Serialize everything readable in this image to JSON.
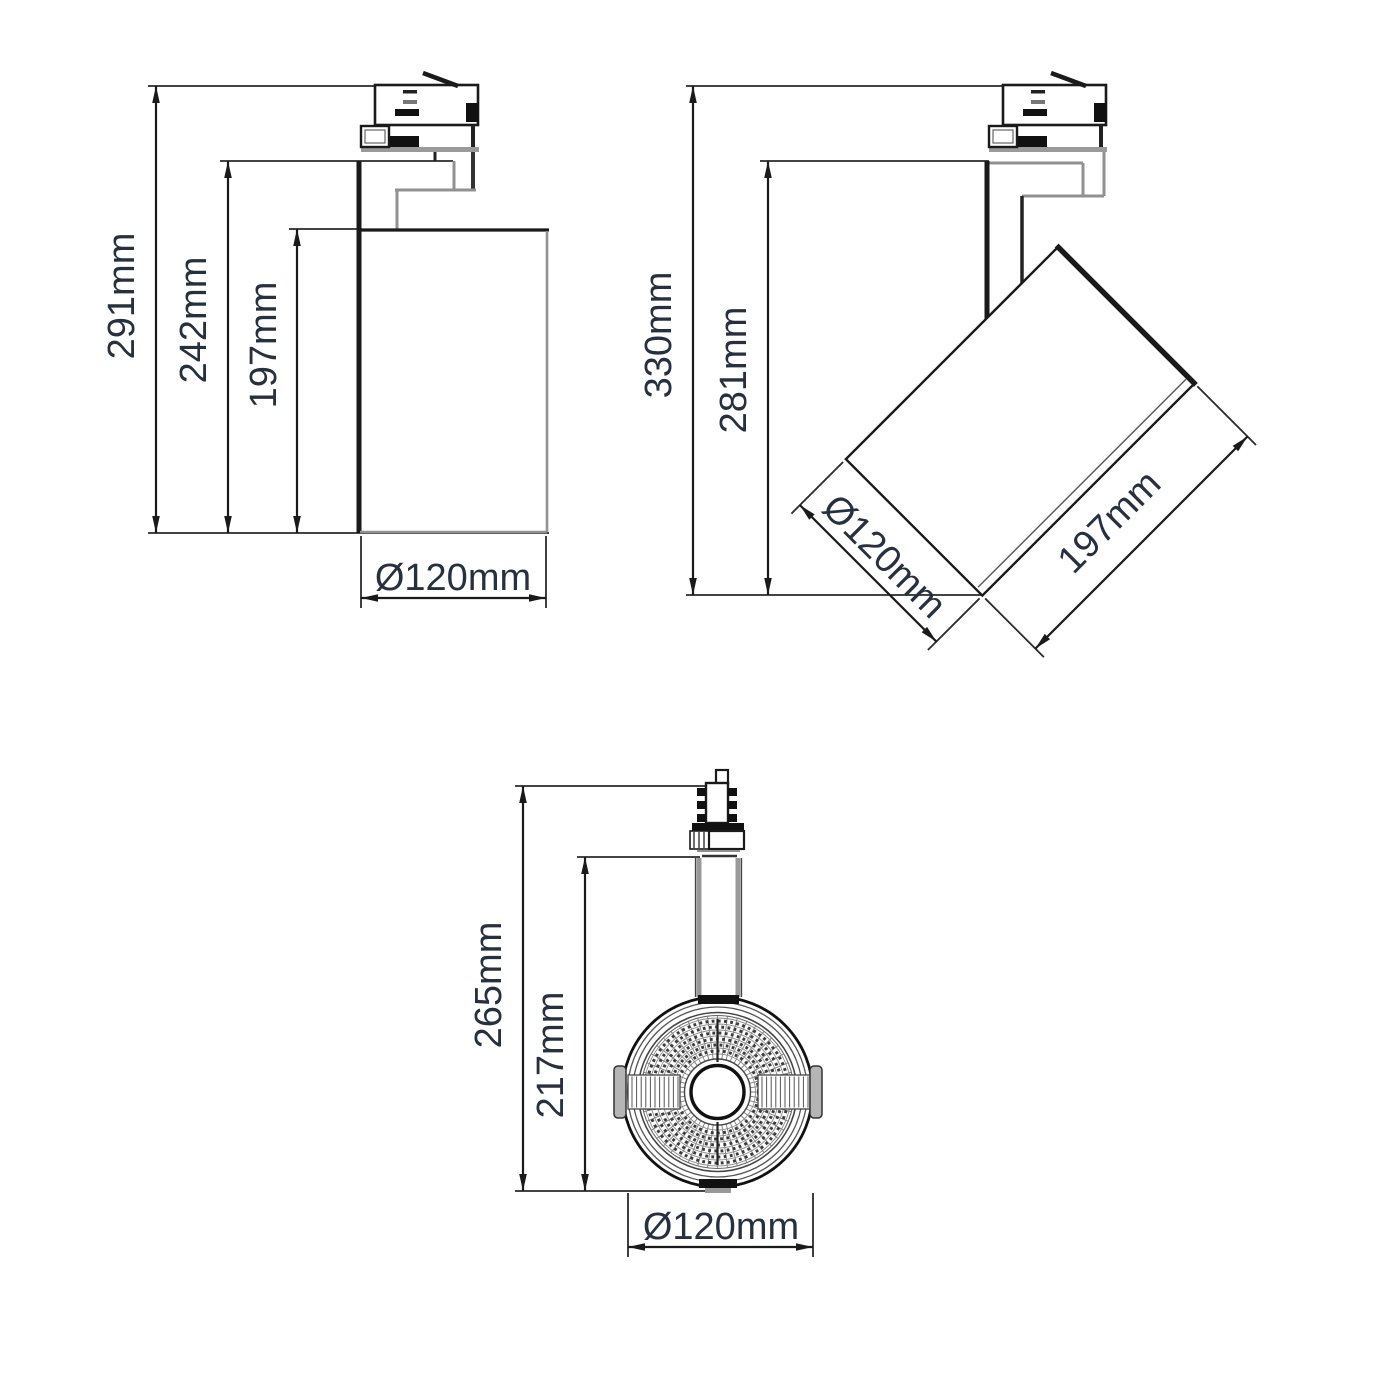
{
  "drawing": {
    "type": "technical-dimension-drawing",
    "subject": "LED track spotlight - three orthographic views",
    "colors": {
      "bg": "#ffffff",
      "line": "#1a1a1a",
      "gray": "#919191",
      "dim_text": "#27303f"
    },
    "views": {
      "side": {
        "title": "side-view-straight",
        "dims": {
          "height_overall": "291mm",
          "height_mid": "242mm",
          "body_length": "197mm",
          "diameter": "Ø120mm"
        }
      },
      "tilted": {
        "title": "side-view-tilted",
        "dims": {
          "height_overall": "330mm",
          "height_mid": "281mm",
          "diameter": "Ø120mm",
          "body_length": "197mm"
        }
      },
      "front": {
        "title": "front-view",
        "dims": {
          "height_overall": "265mm",
          "height_mid": "217mm",
          "diameter": "Ø120mm"
        }
      }
    }
  }
}
